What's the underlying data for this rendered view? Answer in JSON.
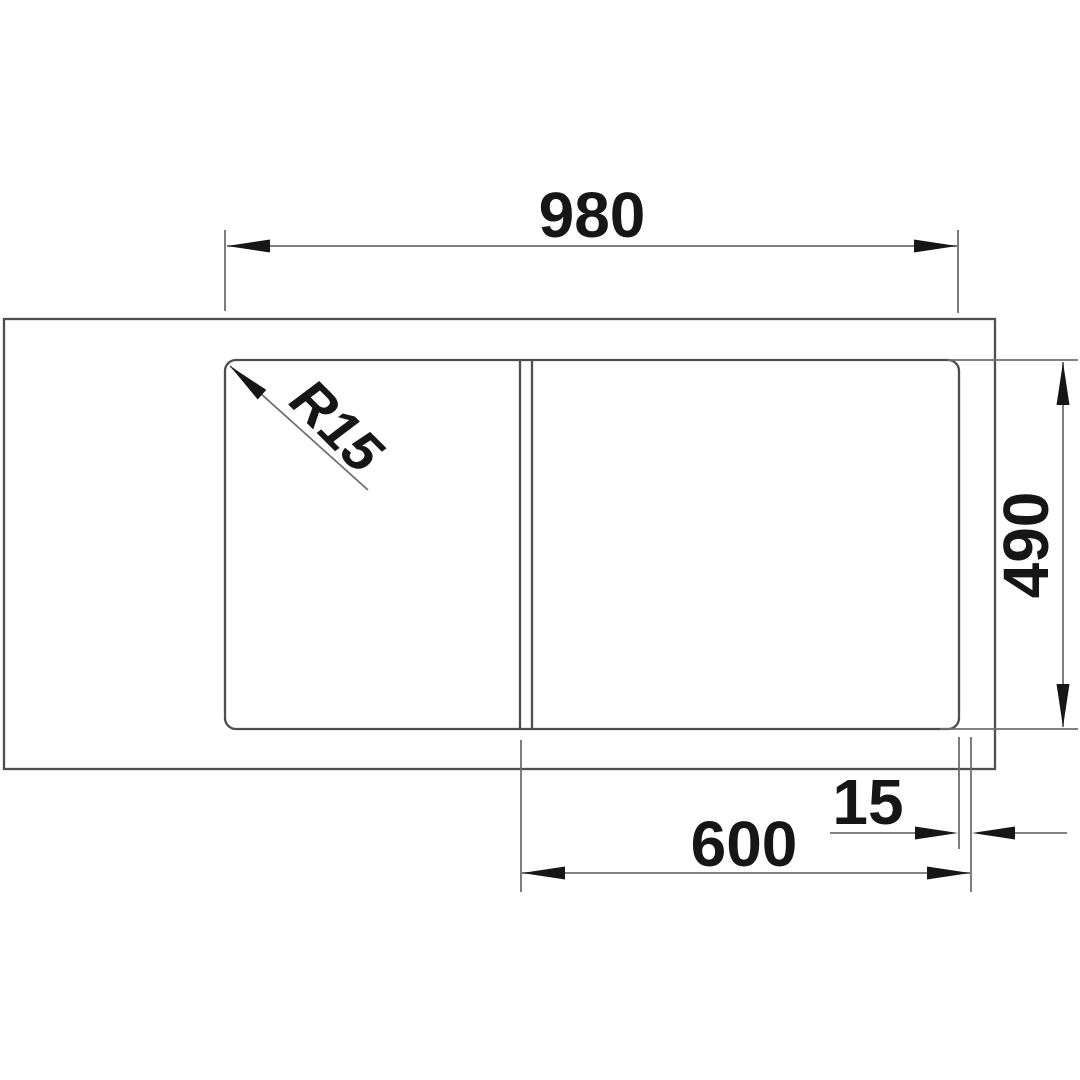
{
  "drawing": {
    "description": "Technical top-view dimension drawing of a kitchen sink with drainer and bowl",
    "labels": {
      "overall_width": "980",
      "depth": "490",
      "bowl_width": "600",
      "edge_offset": "15",
      "corner_radius": "R15"
    },
    "colors": {
      "bg": "#ffffff",
      "outline": "#4e4e4e",
      "dim": "#6f6f6f",
      "ink": "#161616"
    }
  }
}
